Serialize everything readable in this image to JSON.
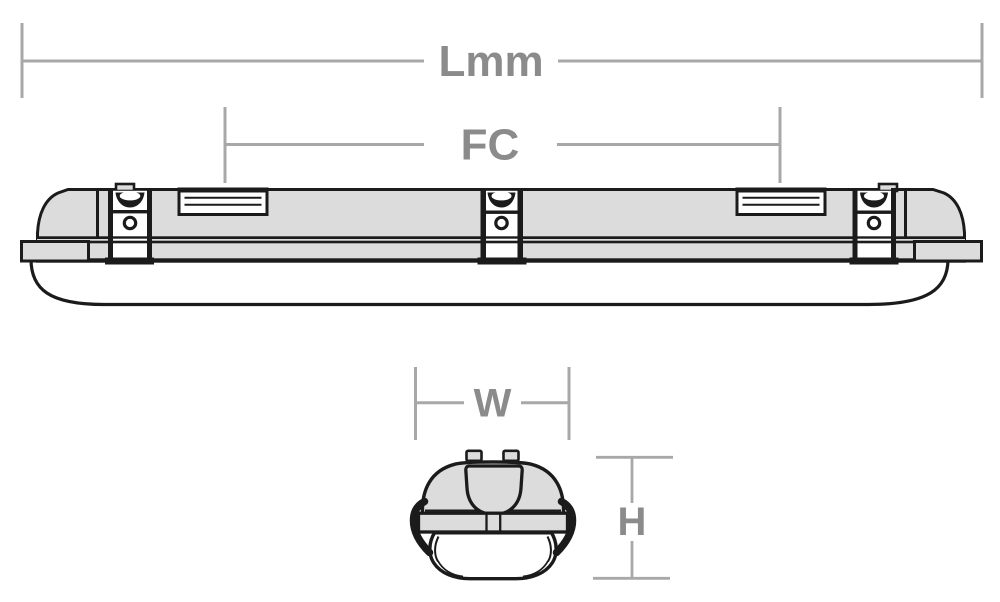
{
  "diagram": {
    "dimensions": {
      "length": {
        "label": "Lmm"
      },
      "fixing_centres": {
        "label": "FC"
      },
      "width": {
        "label": "W"
      },
      "height": {
        "label": "H"
      }
    },
    "colors": {
      "background": "#ffffff",
      "outline": "#1b1b1b",
      "body_fill": "#dcdcdc",
      "diffuser_fill": "#ffffff",
      "dimension_line": "#a8a8a8",
      "dimension_text": "#8b8b8b"
    }
  }
}
